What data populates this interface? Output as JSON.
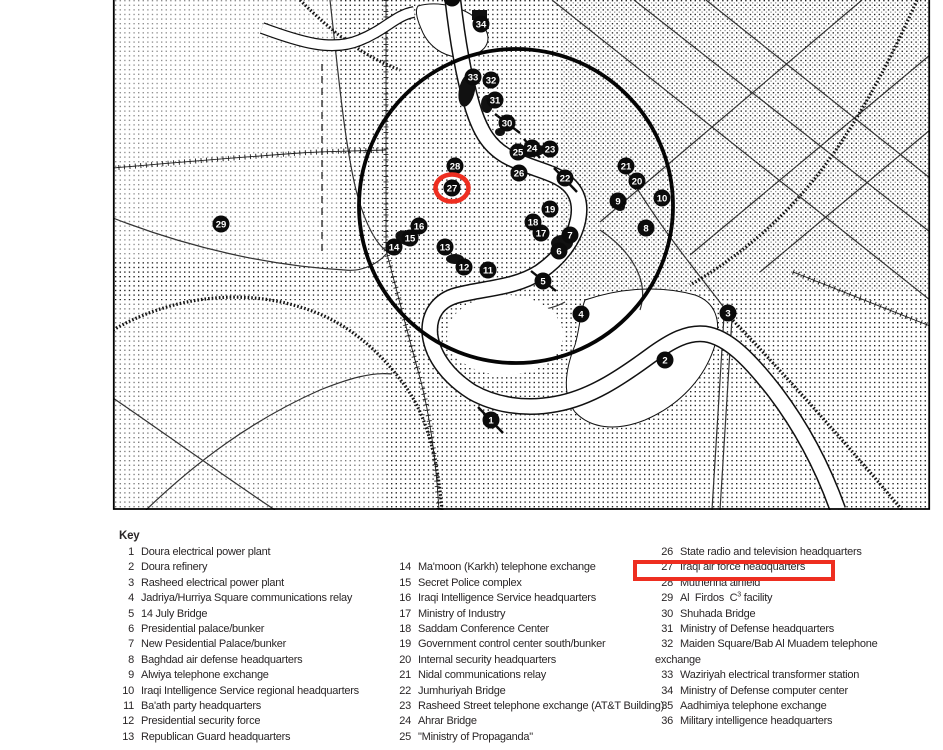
{
  "colors": {
    "accent_red": "#ee2e20",
    "ink": "#2a2627",
    "map_ink": "#0b0b0b"
  },
  "map": {
    "description": "Baghdad downtown target map with stippled terrain, Tigris river, roads, railway and target circle",
    "highlighted_marker": 27,
    "markers": [
      {
        "n": 1,
        "x": 491,
        "y": 420
      },
      {
        "n": 2,
        "x": 665,
        "y": 360
      },
      {
        "n": 3,
        "x": 728,
        "y": 313
      },
      {
        "n": 4,
        "x": 581,
        "y": 314
      },
      {
        "n": 5,
        "x": 543,
        "y": 281
      },
      {
        "n": 6,
        "x": 559,
        "y": 251
      },
      {
        "n": 7,
        "x": 570,
        "y": 235
      },
      {
        "n": 8,
        "x": 646,
        "y": 228
      },
      {
        "n": 9,
        "x": 618,
        "y": 201
      },
      {
        "n": 10,
        "x": 662,
        "y": 198
      },
      {
        "n": 11,
        "x": 488,
        "y": 270
      },
      {
        "n": 12,
        "x": 464,
        "y": 267
      },
      {
        "n": 13,
        "x": 445,
        "y": 247
      },
      {
        "n": 14,
        "x": 394,
        "y": 247
      },
      {
        "n": 15,
        "x": 410,
        "y": 238
      },
      {
        "n": 16,
        "x": 419,
        "y": 226
      },
      {
        "n": 17,
        "x": 541,
        "y": 233
      },
      {
        "n": 18,
        "x": 533,
        "y": 222
      },
      {
        "n": 19,
        "x": 550,
        "y": 209
      },
      {
        "n": 20,
        "x": 637,
        "y": 181
      },
      {
        "n": 21,
        "x": 626,
        "y": 166
      },
      {
        "n": 22,
        "x": 565,
        "y": 178
      },
      {
        "n": 23,
        "x": 550,
        "y": 149
      },
      {
        "n": 24,
        "x": 532,
        "y": 148
      },
      {
        "n": 25,
        "x": 518,
        "y": 152
      },
      {
        "n": 26,
        "x": 519,
        "y": 173
      },
      {
        "n": 27,
        "x": 452,
        "y": 188
      },
      {
        "n": 28,
        "x": 455,
        "y": 166
      },
      {
        "n": 29,
        "x": 221,
        "y": 224
      },
      {
        "n": 30,
        "x": 507,
        "y": 123
      },
      {
        "n": 31,
        "x": 495,
        "y": 100
      },
      {
        "n": 32,
        "x": 491,
        "y": 80
      },
      {
        "n": 33,
        "x": 473,
        "y": 77
      },
      {
        "n": 34,
        "x": 481,
        "y": 24
      },
      {
        "n": "",
        "x": 452,
        "y": -2
      }
    ]
  },
  "key": {
    "title": "Key",
    "highlighted_entry": 27,
    "columns": [
      {
        "entries": [
          {
            "num": 1,
            "text": "Doura electrical power plant"
          },
          {
            "num": 2,
            "text": "Doura refinery"
          },
          {
            "num": 3,
            "text": "Rasheed electrical power plant"
          },
          {
            "num": 4,
            "text": "Jadriya/Hurriya Square communications relay"
          },
          {
            "num": 5,
            "text": "14 July Bridge"
          },
          {
            "num": 6,
            "text": "Presidential palace/bunker"
          },
          {
            "num": 7,
            "text": "New Pesidential Palace/bunker"
          },
          {
            "num": 8,
            "text": "Baghdad air defense headquarters"
          },
          {
            "num": 9,
            "text": "Alwiya telephone exchange"
          },
          {
            "num": 10,
            "text": "Iraqi Intelligence Service regional headquarters"
          },
          {
            "num": 11,
            "text": "Ba'ath party headquarters"
          },
          {
            "num": 12,
            "text": "Presidential security force"
          },
          {
            "num": 13,
            "text": "Republican Guard headquarters"
          }
        ]
      },
      {
        "entries": [
          {
            "num": 14,
            "text": "Ma'moon (Karkh) telephone exchange"
          },
          {
            "num": 15,
            "text": "Secret Police complex"
          },
          {
            "num": 16,
            "text": "Iraqi Intelligence Service headquarters"
          },
          {
            "num": 17,
            "text": "Ministry of Industry"
          },
          {
            "num": 18,
            "text": "Saddam Conference Center"
          },
          {
            "num": 19,
            "text": "Government control center south/bunker"
          },
          {
            "num": 20,
            "text": "Internal security headquarters"
          },
          {
            "num": 21,
            "text": "Nidal communications relay"
          },
          {
            "num": 22,
            "text": "Jumhuriyah Bridge"
          },
          {
            "num": 23,
            "text": "Rasheed Street telephone exchange (AT&T Building)"
          },
          {
            "num": 24,
            "text": "Ahrar Bridge"
          },
          {
            "num": 25,
            "text": "\"Ministry of Propaganda\""
          }
        ]
      },
      {
        "entries": [
          {
            "num": 26,
            "text": "State radio and television headquarters"
          },
          {
            "num": 27,
            "text": "Iraqi air force headquarters"
          },
          {
            "num": 28,
            "text": "Muthenna airfield"
          },
          {
            "num": 29,
            "text": "Al  Firdos  C",
            "sup": "3",
            "text2": " facility"
          },
          {
            "num": 30,
            "text": "Shuhada Bridge"
          },
          {
            "num": 31,
            "text": "Ministry of Defense headquarters"
          },
          {
            "num": 32,
            "text": "Maiden Square/Bab Al Muadem telephone",
            "wrap": "exchange"
          },
          {
            "num": 33,
            "text": "Waziriyah electrical transformer station"
          },
          {
            "num": 34,
            "text": "Ministry of Defense computer center"
          },
          {
            "num": 35,
            "text": "Aadhimiya telephone exchange"
          },
          {
            "num": 36,
            "text": "Military intelligence headquarters"
          }
        ]
      }
    ]
  }
}
